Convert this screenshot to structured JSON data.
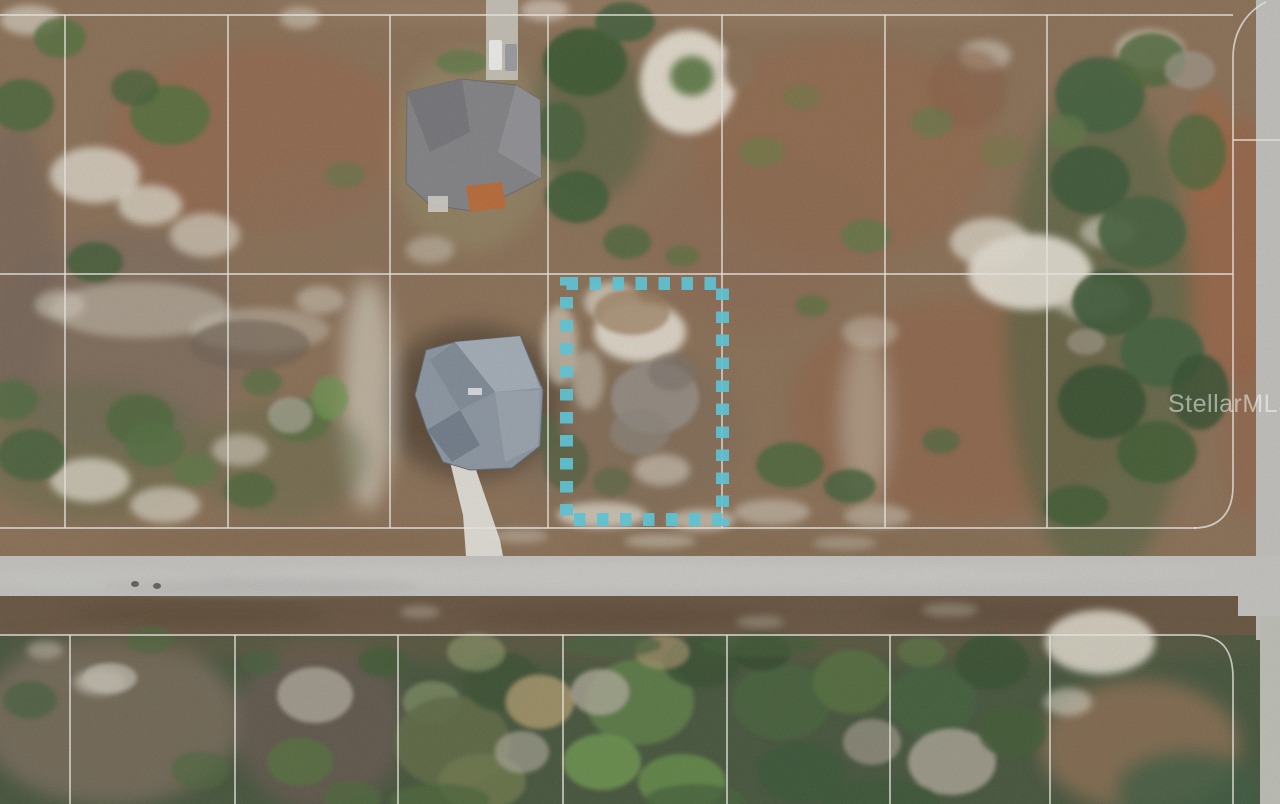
{
  "watermark": {
    "text": "StellarMLS",
    "x": 1168,
    "y": 412,
    "font_size": 25,
    "color": "#ffffff",
    "opacity": 0.5
  },
  "palette": {
    "field_base": "#8d7156",
    "forest_base": "#46553b",
    "ditch": "#6a5540",
    "road": "#cac9c5",
    "road_vertical": "#c7c6c2",
    "pavement_small": "#c3c5ba",
    "parcel_line": "#f6f4ee",
    "highlight": "#5ecfe2"
  },
  "highlight_rect": {
    "x": 566.5,
    "y": 283.5,
    "w": 156,
    "h": 236,
    "stroke_width": 13,
    "dash": 11.5,
    "gap": 11.5,
    "opacity": 0.93
  },
  "parcel": {
    "stroke_width": 1.7,
    "line_opacity": 0.8,
    "top_block": {
      "h_lines": [
        {
          "y": 15,
          "x1": 0,
          "x2": 1233
        },
        {
          "y": 274,
          "x1": 0,
          "x2": 1233
        },
        {
          "y": 528,
          "x1": 0,
          "x2": 1196
        }
      ],
      "v_lines": [
        65,
        228,
        390,
        548,
        722,
        885,
        1047
      ],
      "v_y1": 15,
      "v_y2": 528,
      "right_boundary": "M 1266,2 C 1246,12 1233,32 1233,58 L 1233,486 C 1233,512 1220,528 1194,528",
      "stub": {
        "x1": 1233,
        "y1": 140,
        "x2": 1280,
        "y2": 140
      }
    },
    "bottom_block": {
      "h_line": {
        "y": 635,
        "x1": 0,
        "x2": 1194
      },
      "v_lines": [
        70,
        235,
        398,
        563,
        727,
        890,
        1050
      ],
      "v_y1": 635,
      "v_y2": 804,
      "right_boundary": "M 1194,635 C 1222,635 1233,650 1233,678 L 1233,804"
    }
  },
  "roads": {
    "h_road": {
      "x": 0,
      "y": 556,
      "w": 1280,
      "h": 40
    },
    "v_road": {
      "x": 1256,
      "y": 0,
      "w": 24,
      "h": 640
    },
    "corner_pave": {
      "x": 1238,
      "y": 556,
      "w": 42,
      "h": 60
    },
    "br_pave": {
      "x": 1260,
      "y": 616,
      "w": 20,
      "h": 188
    },
    "details": [
      [
        640,
        576,
        420,
        13,
        "#d7d6d2",
        0.5
      ],
      [
        260,
        586,
        160,
        9,
        "#bab9b5",
        0.45
      ],
      [
        1050,
        572,
        170,
        11,
        "#d2d1cd",
        0.45
      ],
      [
        100,
        578,
        120,
        10,
        "#d2d1ce",
        0.4
      ]
    ],
    "dots": [
      [
        135,
        584
      ],
      [
        157,
        586
      ]
    ],
    "dot_color": "#3c362e"
  },
  "crescent": {
    "ring": {
      "cx": 688,
      "cy": 82,
      "rx": 48,
      "ry": 52,
      "fill": "#efe9db",
      "opacity": 0.92
    },
    "center_green": {
      "cx": 692,
      "cy": 76,
      "rx": 22,
      "ry": 20,
      "fill": "#5d7a44",
      "opacity": 0.95
    },
    "gap": {
      "cx": 740,
      "cy": 68,
      "rx": 16,
      "ry": 22,
      "fill": "#8d7156",
      "opacity": 1
    }
  },
  "soft_patches": [
    [
      260,
      140,
      150,
      95,
      "#9d6245",
      0.5
    ],
    [
      120,
      340,
      130,
      110,
      "#77675f",
      0.5
    ],
    [
      330,
      250,
      120,
      90,
      "#8c7258",
      0.45
    ],
    [
      620,
      430,
      120,
      90,
      "#7d6a58",
      0.45
    ],
    [
      840,
      150,
      150,
      110,
      "#9a6647",
      0.45
    ],
    [
      960,
      410,
      170,
      110,
      "#95603f",
      0.5
    ],
    [
      1240,
      250,
      55,
      130,
      "#a55c38",
      0.5
    ],
    [
      760,
      240,
      120,
      90,
      "#8f6a4e",
      0.4
    ],
    [
      640,
      8,
      380,
      16,
      "#a28467",
      0.5
    ],
    [
      15,
      270,
      40,
      150,
      "#6f6055",
      0.5
    ],
    [
      473,
      402,
      92,
      80,
      "#63503a",
      0.9
    ],
    [
      470,
      400,
      72,
      62,
      "#54422e",
      0.55
    ],
    [
      110,
      720,
      130,
      85,
      "#7b6c5c",
      0.85
    ],
    [
      320,
      725,
      85,
      85,
      "#6b5a52",
      0.75
    ],
    [
      1140,
      745,
      100,
      65,
      "#8a6f52",
      0.9
    ],
    [
      1190,
      790,
      75,
      40,
      "#3c5b3f",
      0.8
    ],
    [
      640,
      645,
      640,
      16,
      "#6d5942",
      0.5
    ],
    [
      368,
      395,
      26,
      115,
      "#d8d1c0",
      0.7
    ],
    [
      865,
      420,
      24,
      85,
      "#cfc7b5",
      0.5
    ],
    [
      200,
      615,
      130,
      13,
      "#55412f",
      0.55
    ],
    [
      620,
      618,
      150,
      13,
      "#5a4632",
      0.55
    ],
    [
      1000,
      614,
      130,
      13,
      "#55412f",
      0.5
    ],
    [
      300,
      542,
      200,
      11,
      "#7d6348",
      0.5
    ],
    [
      820,
      545,
      240,
      11,
      "#7d6348",
      0.45
    ],
    [
      472,
      150,
      80,
      102,
      "#9a9168",
      0.5
    ],
    [
      1100,
      330,
      95,
      250,
      "#41603a",
      0.5
    ],
    [
      90,
      450,
      120,
      70,
      "#5e6b47",
      0.45
    ],
    [
      280,
      460,
      90,
      60,
      "#5f6d48",
      0.45
    ],
    [
      590,
      120,
      60,
      80,
      "#3f5c36",
      0.5
    ],
    [
      1245,
      430,
      20,
      90,
      "#9a5f41",
      0.45
    ]
  ],
  "sand_patches": [
    [
      95,
      175,
      45,
      28,
      "#e7e1d3",
      0.8
    ],
    [
      150,
      205,
      32,
      20,
      "#e7e1d3",
      0.75
    ],
    [
      205,
      235,
      35,
      22,
      "#ddd6c6",
      0.7
    ],
    [
      60,
      305,
      25,
      15,
      "#ddd6c6",
      0.55
    ],
    [
      90,
      480,
      40,
      22,
      "#e7e1d3",
      0.75
    ],
    [
      165,
      505,
      35,
      18,
      "#e0dacb",
      0.7
    ],
    [
      240,
      450,
      28,
      16,
      "#ddd6c6",
      0.6
    ],
    [
      320,
      300,
      24,
      14,
      "#d8d1c1",
      0.55
    ],
    [
      430,
      250,
      24,
      14,
      "#d8d1c1",
      0.5
    ],
    [
      640,
      332,
      46,
      30,
      "#ece6d8",
      0.9
    ],
    [
      612,
      302,
      28,
      20,
      "#e0d9c9",
      0.75
    ],
    [
      662,
      470,
      28,
      16,
      "#ddd6c6",
      0.6
    ],
    [
      602,
      515,
      45,
      13,
      "#e7e1d3",
      0.75
    ],
    [
      702,
      520,
      33,
      11,
      "#e0dacb",
      0.65
    ],
    [
      1030,
      272,
      62,
      38,
      "#eee9dc",
      0.9
    ],
    [
      990,
      242,
      40,
      24,
      "#e7e1d3",
      0.75
    ],
    [
      1092,
      300,
      38,
      20,
      "#ddd6c6",
      0.6
    ],
    [
      1108,
      232,
      28,
      16,
      "#e0dacb",
      0.6
    ],
    [
      1150,
      50,
      34,
      20,
      "#e0dacb",
      0.7
    ],
    [
      985,
      55,
      26,
      15,
      "#ddd6c6",
      0.55
    ],
    [
      30,
      20,
      30,
      15,
      "#e7e1d3",
      0.65
    ],
    [
      300,
      18,
      20,
      11,
      "#e0dacb",
      0.55
    ],
    [
      545,
      10,
      24,
      11,
      "#e7e1d3",
      0.6
    ],
    [
      870,
      332,
      28,
      16,
      "#d8d1c1",
      0.45
    ],
    [
      772,
      512,
      38,
      13,
      "#ddd6c6",
      0.55
    ],
    [
      877,
      516,
      33,
      12,
      "#d8d1c1",
      0.5
    ],
    [
      1100,
      642,
      55,
      32,
      "#ece6d8",
      0.85
    ],
    [
      1068,
      702,
      24,
      14,
      "#e0dacb",
      0.6
    ],
    [
      100,
      682,
      26,
      13,
      "#cfc9ba",
      0.7
    ],
    [
      45,
      650,
      18,
      9,
      "#cfc9ba",
      0.5
    ],
    [
      140,
      310,
      90,
      28,
      "#d8d1c1",
      0.5
    ],
    [
      260,
      330,
      70,
      22,
      "#d5cebe",
      0.45
    ],
    [
      560,
      345,
      18,
      40,
      "#e3ddcd",
      0.6
    ],
    [
      588,
      380,
      16,
      30,
      "#ddd6c6",
      0.5
    ],
    [
      420,
      612,
      20,
      6,
      "#c9c2b2",
      0.45
    ],
    [
      760,
      622,
      24,
      6,
      "#c9c2b2",
      0.4
    ],
    [
      950,
      610,
      28,
      7,
      "#bdb5a4",
      0.45
    ],
    [
      520,
      536,
      28,
      7,
      "#cfc8b8",
      0.5
    ],
    [
      660,
      541,
      36,
      7,
      "#d6cfbf",
      0.55
    ],
    [
      845,
      543,
      32,
      7,
      "#cfc8b8",
      0.45
    ],
    [
      968,
      88,
      40,
      40,
      "#8b5e40",
      0.5
    ],
    [
      1210,
      150,
      22,
      60,
      "#a8623e",
      0.5
    ]
  ],
  "trees": [
    [
      22,
      105,
      32,
      26,
      "#4c683a",
      0.9
    ],
    [
      60,
      38,
      26,
      20,
      "#55713c",
      0.85
    ],
    [
      170,
      115,
      40,
      30,
      "#55713c",
      0.9
    ],
    [
      135,
      88,
      24,
      18,
      "#47623a",
      0.8
    ],
    [
      95,
      262,
      28,
      20,
      "#3f5c33",
      0.8
    ],
    [
      140,
      420,
      34,
      26,
      "#4c683a",
      0.85
    ],
    [
      300,
      420,
      30,
      22,
      "#55713c",
      0.8
    ],
    [
      32,
      455,
      34,
      26,
      "#47623a",
      0.85
    ],
    [
      250,
      490,
      26,
      18,
      "#4c683a",
      0.8
    ],
    [
      345,
      175,
      20,
      13,
      "#5d7a44",
      0.55
    ],
    [
      462,
      62,
      26,
      12,
      "#5d7a44",
      0.75
    ],
    [
      585,
      62,
      42,
      34,
      "#3c5830",
      0.95
    ],
    [
      625,
      22,
      30,
      20,
      "#44603a",
      0.9
    ],
    [
      560,
      132,
      26,
      30,
      "#44603a",
      0.85
    ],
    [
      577,
      197,
      32,
      26,
      "#3f5c33",
      0.9
    ],
    [
      627,
      242,
      24,
      17,
      "#4c683a",
      0.8
    ],
    [
      682,
      256,
      17,
      11,
      "#55713c",
      0.65
    ],
    [
      762,
      152,
      23,
      15,
      "#6f7c44",
      0.7
    ],
    [
      802,
      97,
      19,
      13,
      "#6f7c44",
      0.55
    ],
    [
      866,
      236,
      25,
      17,
      "#5d7a44",
      0.7
    ],
    [
      932,
      122,
      21,
      15,
      "#647d48",
      0.6
    ],
    [
      1002,
      152,
      23,
      15,
      "#6f7c44",
      0.5
    ],
    [
      812,
      306,
      17,
      11,
      "#55713c",
      0.65
    ],
    [
      790,
      465,
      34,
      23,
      "#4c683a",
      0.9
    ],
    [
      850,
      486,
      26,
      17,
      "#47623a",
      0.85
    ],
    [
      941,
      441,
      19,
      13,
      "#4c683a",
      0.7
    ],
    [
      1076,
      506,
      33,
      21,
      "#3f5c33",
      0.85
    ],
    [
      1100,
      95,
      45,
      38,
      "#41603a",
      0.9
    ],
    [
      1152,
      60,
      34,
      27,
      "#4c683a",
      0.85
    ],
    [
      1090,
      180,
      40,
      34,
      "#3a5634",
      0.9
    ],
    [
      1142,
      232,
      44,
      36,
      "#44603a",
      0.9
    ],
    [
      1112,
      302,
      40,
      33,
      "#3a5634",
      0.9
    ],
    [
      1162,
      352,
      42,
      35,
      "#41603a",
      0.9
    ],
    [
      1102,
      402,
      44,
      37,
      "#35502f",
      0.9
    ],
    [
      1157,
      452,
      40,
      31,
      "#3f5c33",
      0.88
    ],
    [
      1197,
      152,
      29,
      38,
      "#4c683a",
      0.8
    ],
    [
      1200,
      392,
      29,
      38,
      "#35502f",
      0.85
    ],
    [
      1066,
      132,
      21,
      17,
      "#5d7a44",
      0.65
    ],
    [
      1190,
      70,
      25,
      19,
      "#a8a093",
      0.65
    ],
    [
      1086,
      342,
      19,
      13,
      "#b0a899",
      0.55
    ],
    [
      566,
      462,
      23,
      28,
      "#54603f",
      0.8
    ],
    [
      612,
      482,
      19,
      15,
      "#5a6a42",
      0.7
    ],
    [
      655,
      398,
      44,
      36,
      "#99928a",
      0.85
    ],
    [
      640,
      432,
      30,
      23,
      "#8d867c",
      0.7
    ],
    [
      672,
      372,
      24,
      19,
      "#7b746b",
      0.6
    ],
    [
      632,
      312,
      38,
      23,
      "#9b7d5c",
      0.7
    ],
    [
      543,
      432,
      15,
      19,
      "#51633e",
      0.8
    ],
    [
      12,
      400,
      26,
      20,
      "#4f6b3d",
      0.8
    ],
    [
      155,
      445,
      30,
      22,
      "#537040",
      0.8
    ],
    [
      195,
      470,
      22,
      16,
      "#5d7a44",
      0.7
    ],
    [
      262,
      382,
      20,
      14,
      "#537040",
      0.7
    ],
    [
      330,
      398,
      18,
      22,
      "#6f9a50",
      0.75
    ],
    [
      290,
      415,
      22,
      18,
      "#b2ab9c",
      0.7
    ],
    [
      250,
      345,
      60,
      25,
      "#6e6053",
      0.6
    ],
    [
      150,
      640,
      24,
      14,
      "#4c683a",
      0.65
    ],
    [
      30,
      700,
      27,
      19,
      "#42603a",
      0.7
    ],
    [
      200,
      770,
      29,
      19,
      "#4c683a",
      0.65
    ],
    [
      110,
      678,
      27,
      15,
      "#c6c0b2",
      0.75
    ],
    [
      315,
      695,
      38,
      28,
      "#b4ad9e",
      0.8
    ],
    [
      300,
      762,
      33,
      24,
      "#55713c",
      0.85
    ],
    [
      352,
      798,
      29,
      17,
      "#4c683a",
      0.75
    ],
    [
      262,
      662,
      19,
      13,
      "#47623a",
      0.65
    ],
    [
      382,
      662,
      24,
      15,
      "#3f5c33",
      0.75
    ],
    [
      432,
      702,
      29,
      21,
      "#8b9a6b",
      0.65
    ],
    [
      452,
      742,
      58,
      46,
      "#5f6b42",
      0.9
    ],
    [
      502,
      682,
      39,
      30,
      "#3a5232",
      0.9
    ],
    [
      482,
      782,
      44,
      28,
      "#6e7a4a",
      0.85
    ],
    [
      540,
      702,
      34,
      27,
      "#b5a071",
      0.8
    ],
    [
      476,
      652,
      29,
      19,
      "#8f9a68",
      0.65
    ],
    [
      640,
      702,
      54,
      43,
      "#5d8046",
      0.9
    ],
    [
      602,
      762,
      39,
      28,
      "#6f9a50",
      0.85
    ],
    [
      682,
      782,
      44,
      28,
      "#659048",
      0.85
    ],
    [
      600,
      692,
      29,
      23,
      "#b9b2a2",
      0.75
    ],
    [
      522,
      752,
      27,
      21,
      "#b4ad9e",
      0.65
    ],
    [
      702,
      662,
      39,
      26,
      "#35502f",
      0.85
    ],
    [
      662,
      652,
      27,
      17,
      "#ac9a6f",
      0.65
    ],
    [
      782,
      702,
      49,
      38,
      "#46633a",
      0.9
    ],
    [
      852,
      682,
      39,
      32,
      "#55713c",
      0.85
    ],
    [
      802,
      772,
      44,
      30,
      "#3a5634",
      0.88
    ],
    [
      872,
      742,
      29,
      23,
      "#aaa294",
      0.65
    ],
    [
      762,
      652,
      29,
      19,
      "#2f4529",
      0.75
    ],
    [
      932,
      702,
      44,
      36,
      "#41603a",
      0.9
    ],
    [
      992,
      662,
      37,
      28,
      "#35502f",
      0.88
    ],
    [
      952,
      762,
      44,
      33,
      "#b4ad9e",
      0.8
    ],
    [
      1012,
      732,
      34,
      26,
      "#3f5c33",
      0.82
    ],
    [
      922,
      652,
      24,
      15,
      "#5d7a44",
      0.65
    ],
    [
      612,
      645,
      50,
      12,
      "#46633a",
      0.7
    ],
    [
      760,
      645,
      60,
      12,
      "#3f5c33",
      0.7
    ],
    [
      880,
      800,
      60,
      20,
      "#3a5634",
      0.8
    ],
    [
      440,
      800,
      50,
      16,
      "#4c683a",
      0.8
    ],
    [
      695,
      800,
      50,
      16,
      "#46633a",
      0.8
    ]
  ],
  "house_a": {
    "roof": "407,92 462,79 516,85 540,100 541,178 512,193 472,211 430,205 406,183",
    "roof_fill": "#858588",
    "facet_dark": "407,92 462,79 470,132 430,152",
    "facet_dark_fill": "#76767a",
    "facet_light": "516,85 540,100 541,178 498,152",
    "facet_light_fill": "#96969a",
    "patio": "466,186 502,182 506,208 470,212",
    "patio_fill": "#c06a33",
    "shed": {
      "x": 428,
      "y": 196,
      "w": 20,
      "h": 16,
      "fill": "#d8d5ce"
    },
    "driveway": {
      "x": 486,
      "y": 0,
      "w": 32,
      "h": 80,
      "fill": "#cfccc3"
    },
    "car1": {
      "x": 489,
      "y": 40,
      "w": 13,
      "h": 30,
      "fill": "#f4f4f2"
    },
    "car2": {
      "x": 505,
      "y": 44,
      "w": 12,
      "h": 27,
      "fill": "#9da0a4"
    }
  },
  "house_b": {
    "roof": "426,350 455,342 520,336 543,390 540,446 512,468 470,470 443,462 427,430 415,395",
    "roof_fill": "#8f9aa6",
    "facets": [
      {
        "points": "455,342 520,336 540,388 495,392",
        "fill": "#adb6bf",
        "opacity": 0.85
      },
      {
        "points": "430,360 455,342 495,392 460,410",
        "fill": "#7e8b99",
        "opacity": 0.8
      },
      {
        "points": "427,430 460,410 480,445 452,462",
        "fill": "#6b7888",
        "opacity": 0.8
      },
      {
        "points": "495,392 540,390 538,446 505,462",
        "fill": "#a3adb6",
        "opacity": 0.7
      }
    ],
    "vent": {
      "x": 468,
      "y": 388,
      "w": 14,
      "h": 7,
      "fill": "#dde1e4"
    },
    "driveway": "450,462 472,458 500,540 503,556 466,556 463,515",
    "driveway_fill": "#eceae4"
  }
}
